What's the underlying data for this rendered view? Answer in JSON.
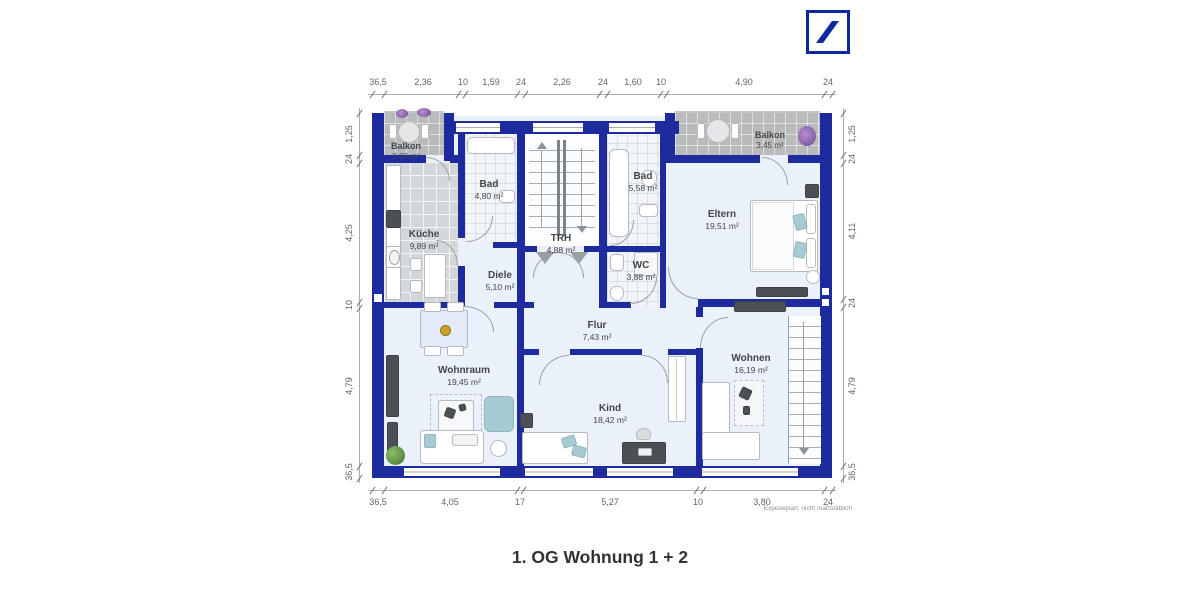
{
  "logo": {
    "name": "deutsche-bank-logo",
    "color": "#0c2a9e"
  },
  "caption": "1. OG Wohnung 1 + 2",
  "footnote": "Exposéplan, nicht maßstäblich",
  "colors": {
    "wall": "#1d2b9e",
    "floor": "#ebf1fb",
    "balcony_tile": "#b8babc",
    "kitchen_tile": "#d4d7da",
    "accent_teal": "#a7cbd2",
    "logo_blue": "#0c2a9e"
  },
  "dimensions": {
    "top": [
      "36,5",
      "2,36",
      "10",
      "1,59",
      "24",
      "2,26",
      "24",
      "1,60",
      "10",
      "4,90",
      "24"
    ],
    "bottom": [
      "36,5",
      "4,05",
      "17",
      "5,27",
      "10",
      "3,80",
      "24"
    ],
    "left": [
      "1,25",
      "24",
      "4,25",
      "10",
      "4,79",
      "36,5"
    ],
    "right": [
      "1,25",
      "24",
      "4,11",
      "24",
      "4,79",
      "36,5"
    ]
  },
  "rooms": [
    {
      "name": "Balkon",
      "area": "2,00 m²"
    },
    {
      "name": "Küche",
      "area": "9,89 m²"
    },
    {
      "name": "Bad",
      "area": "4,80 m²"
    },
    {
      "name": "TRH",
      "area": "4,88 m²"
    },
    {
      "name": "Bad",
      "area": "5,58 m²"
    },
    {
      "name": "Balkon",
      "area": "3,45 m²"
    },
    {
      "name": "Eltern",
      "area": "19,51 m²"
    },
    {
      "name": "Diele",
      "area": "5,10 m²"
    },
    {
      "name": "WC",
      "area": "3,88 m²"
    },
    {
      "name": "Flur",
      "area": "7,43 m²"
    },
    {
      "name": "Wohnraum",
      "area": "19,45 m²"
    },
    {
      "name": "Kind",
      "area": "18,42 m²"
    },
    {
      "name": "Wohnen",
      "area": "16,19 m²"
    }
  ]
}
